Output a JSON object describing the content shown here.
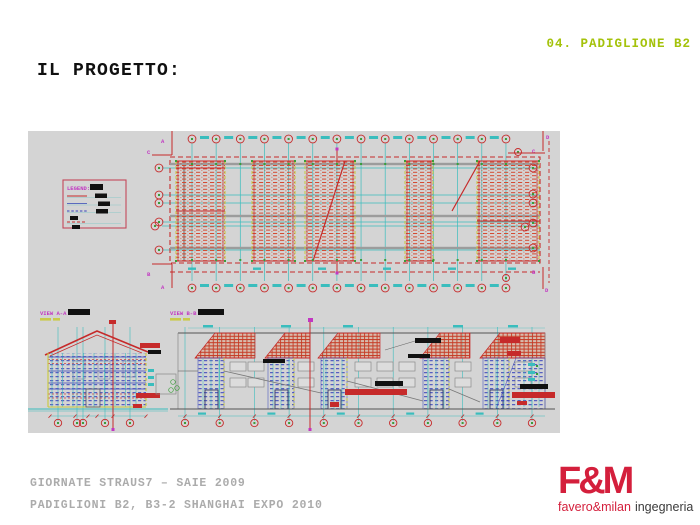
{
  "header": {
    "tag": "04. PADIGLIONE B2"
  },
  "title": "IL PROGETTO:",
  "drawing": {
    "legend": {
      "title": "LEGEND:"
    },
    "views": {
      "a_label": "VIEW A-A",
      "b_label": "VIEW B-B"
    },
    "plan": {
      "markers": {
        "tl": [
          "A",
          "C"
        ],
        "bl": [
          "B",
          "A"
        ],
        "tr": [
          "D",
          "C"
        ],
        "br": [
          "B",
          "D"
        ]
      }
    }
  },
  "footer": {
    "line1": "GIORNATE STRAUS7 – SAIE 2009",
    "line2": "PADIGLIONI B2, B3-2 SHANGHAI EXPO 2010"
  },
  "logo": {
    "mark": "F&M",
    "brand_red": "favero&milan",
    "brand_dark": "ingegneria"
  },
  "colors": {
    "header_tag": "#a4c20a",
    "canvas_gray": "#d4d4d4",
    "cad_red": "#c62a2a",
    "hatch_red": "#d5472e",
    "cad_cyan": "#3abdbd",
    "cad_blue": "#3742bb",
    "cad_yellow": "#c9c93b",
    "cad_magenta": "#c237c2",
    "cad_green": "#3a9e3a",
    "footer_gray": "#ababab",
    "logo_red": "#d41f3c"
  }
}
